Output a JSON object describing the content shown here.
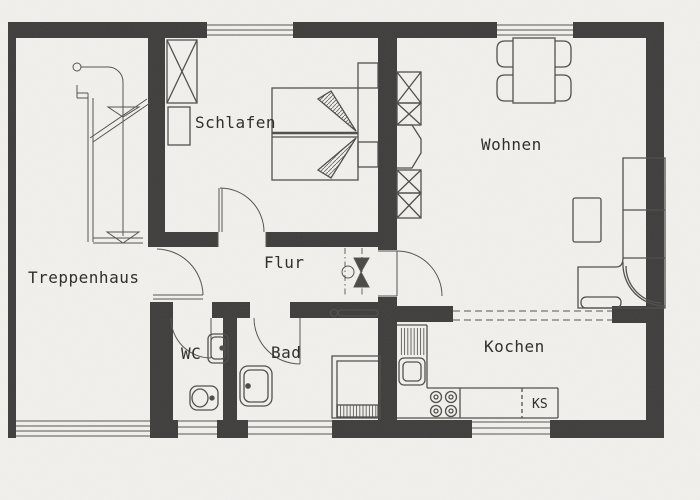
{
  "plan": {
    "rooms": {
      "treppenhaus": "Treppenhaus",
      "schlafen": "Schlafen",
      "wohnen": "Wohnen",
      "flur": "Flur",
      "wc": "WC",
      "bad": "Bad",
      "kochen": "Kochen",
      "ks": "KS"
    },
    "palette": {
      "background": "#f2f0ed",
      "wall": "#3f3e3c",
      "line": "#4a4947",
      "text": "#2d2c2a"
    }
  }
}
